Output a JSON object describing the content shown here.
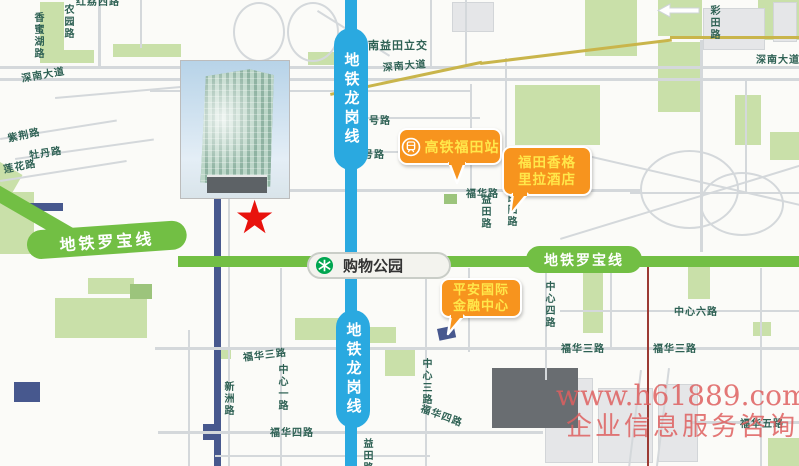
{
  "metro": {
    "luobao_line": {
      "name": "地铁罗宝线",
      "color": "#72bf44"
    },
    "longgang_line": {
      "name": "地铁龙岗线",
      "color": "#2aa9e0"
    },
    "station": {
      "name": "购物公园",
      "logo": "shenzhen-metro-logo",
      "logo_color": "#00a650"
    }
  },
  "callouts": {
    "bubble_color": "#f7941e",
    "text_color": "#ffe74a",
    "futian_rail_station": {
      "label": "高铁福田站",
      "icon": "train-icon"
    },
    "shangri_la_hotel": {
      "line1": "福田香格",
      "line2": "里拉酒店"
    },
    "pingan_ifc": {
      "line1": "平安国际",
      "line2": "金融中心"
    }
  },
  "marker": {
    "shape": "star",
    "glyph": "★",
    "color": "#e8120d"
  },
  "watermark": {
    "line1": "www.h61889.com",
    "line2": "企业信息服务咨询",
    "color": "#de5f5f"
  },
  "roads": [
    {
      "text": "深南大道"
    },
    {
      "text": "深南益田立交"
    },
    {
      "text": "深南大道"
    },
    {
      "text": "深南大道"
    },
    {
      "text": "彩田路"
    },
    {
      "text": "农园路"
    },
    {
      "text": "香蜜湖路"
    },
    {
      "text": "紫荆路"
    },
    {
      "text": "牡丹路"
    },
    {
      "text": "莲花路"
    },
    {
      "text": "一号路"
    },
    {
      "text": "三号路"
    },
    {
      "text": "福华路"
    },
    {
      "text": "益田路"
    },
    {
      "text": "民田路"
    },
    {
      "text": "中心四路"
    },
    {
      "text": "中心六路"
    },
    {
      "text": "福华三路"
    },
    {
      "text": "福华三路"
    },
    {
      "text": "福华三路"
    },
    {
      "text": "中心一路"
    },
    {
      "text": "中心三路"
    },
    {
      "text": "新洲路"
    },
    {
      "text": "福华四路"
    },
    {
      "text": "福华四路"
    },
    {
      "text": "福华五路"
    },
    {
      "text": "红荔西路"
    },
    {
      "text": "益田路"
    }
  ]
}
